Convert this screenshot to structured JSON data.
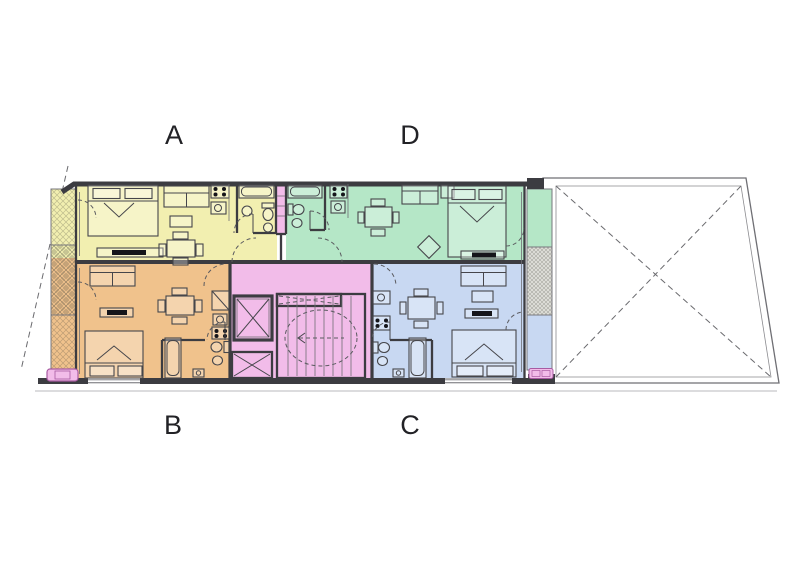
{
  "page": {
    "description": "Architectural floor plan of an apartment building level with four units around a central stair and elevator core, plus a large open terrace with dashed X marking on the right.",
    "background": "#ffffff"
  },
  "units": [
    {
      "label": "A",
      "position": "top-left",
      "color": "#f2efb0",
      "rooms": [
        "living-dining",
        "bedroom",
        "kitchen",
        "bathroom",
        "balcony"
      ],
      "furniture": [
        "double-bed",
        "tv-unit",
        "sofa",
        "coffee-table",
        "dining-table-4-chairs",
        "stove",
        "kitchen-sink",
        "bathtub",
        "toilet",
        "bidet",
        "wash-basin"
      ]
    },
    {
      "label": "B",
      "position": "bottom-left",
      "color": "#f0c28c",
      "rooms": [
        "living-dining",
        "bedroom",
        "kitchen",
        "bathroom",
        "balcony"
      ],
      "furniture": [
        "sofa",
        "tv-unit",
        "double-bed",
        "dining-table-4-chairs",
        "fridge",
        "kitchen-sink",
        "stove",
        "bathtub",
        "toilet",
        "bidet",
        "wash-basin"
      ]
    },
    {
      "label": "C",
      "position": "bottom-right",
      "color": "#c8d8f2",
      "rooms": [
        "living-dining",
        "bedroom",
        "kitchen",
        "bathroom",
        "balcony"
      ],
      "furniture": [
        "kitchen-sink",
        "stove",
        "dining-table-4-chairs",
        "sofa",
        "coffee-table",
        "tv-unit",
        "double-bed",
        "bathtub",
        "toilet",
        "bidet",
        "wash-basin"
      ]
    },
    {
      "label": "D",
      "position": "top-right",
      "color": "#b5e7c7",
      "rooms": [
        "living-dining",
        "bedroom",
        "kitchen",
        "bathroom",
        "balcony"
      ],
      "furniture": [
        "bathtub",
        "toilet",
        "bidet",
        "stove",
        "kitchen-sink",
        "dining-table-4-chairs",
        "sofa",
        "side-table",
        "armchair",
        "double-bed",
        "tv-unit"
      ]
    }
  ],
  "core": {
    "color": "#f2bce9",
    "features": [
      "elevator",
      "staircase",
      "landing",
      "service-shaft",
      "duct"
    ]
  },
  "terrace": {
    "fill": "#ffffff",
    "marking": "dashed-x-diagonals"
  },
  "accents": {
    "pink_highlight": "#f2bce9",
    "hatch_strip": "#e0e0da",
    "wall": "#3c3c41",
    "line": "#5a5a5f"
  }
}
